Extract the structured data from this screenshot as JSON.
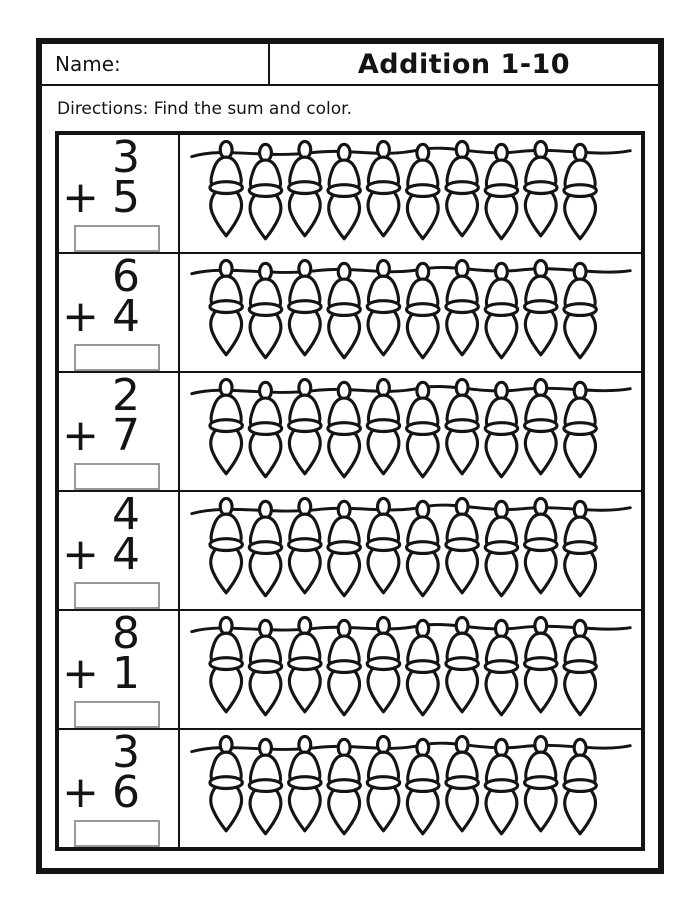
{
  "header": {
    "name_label": "Name:",
    "title": "Addition 1-10"
  },
  "directions": "Directions: Find the sum and color.",
  "problems": [
    {
      "top": "3",
      "op": "+",
      "bottom": "5",
      "answer": "",
      "lights": 10
    },
    {
      "top": "6",
      "op": "+",
      "bottom": "4",
      "answer": "",
      "lights": 10
    },
    {
      "top": "2",
      "op": "+",
      "bottom": "7",
      "answer": "",
      "lights": 10
    },
    {
      "top": "4",
      "op": "+",
      "bottom": "4",
      "answer": "",
      "lights": 10
    },
    {
      "top": "8",
      "op": "+",
      "bottom": "1",
      "answer": "",
      "lights": 10
    },
    {
      "top": "3",
      "op": "+",
      "bottom": "6",
      "answer": "",
      "lights": 10
    }
  ],
  "colors": {
    "ink": "#141414",
    "box_border": "#999999",
    "background": "#ffffff"
  }
}
